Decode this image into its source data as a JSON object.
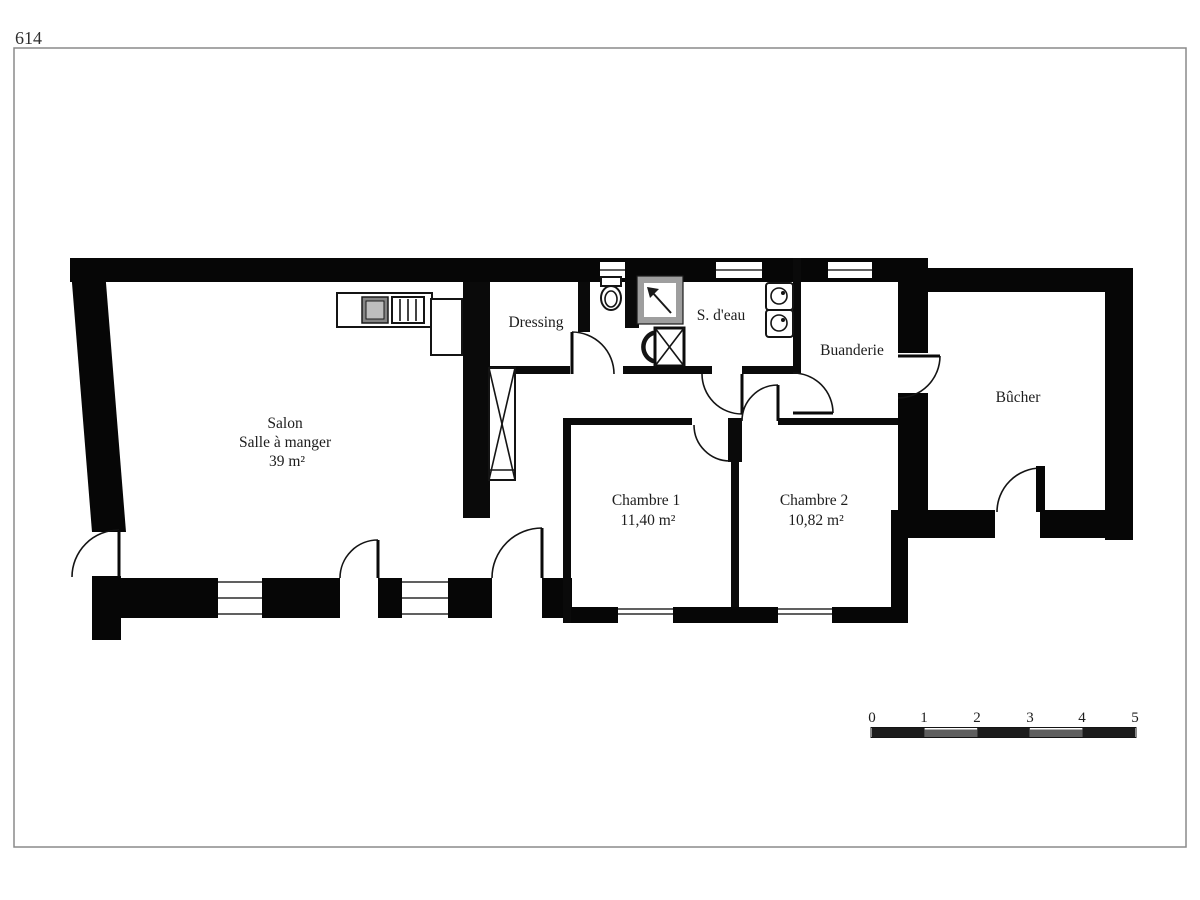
{
  "page": {
    "number": "614"
  },
  "rooms": {
    "salon": {
      "name": "Salon",
      "name2": "Salle à manger",
      "area": "39 m²"
    },
    "dressing": {
      "name": "Dressing"
    },
    "shower_room": {
      "name": "S. d'eau"
    },
    "laundry": {
      "name": "Buanderie"
    },
    "woodshed": {
      "name": "Bûcher"
    },
    "bedroom1": {
      "name": "Chambre 1",
      "area": "11,40 m²"
    },
    "bedroom2": {
      "name": "Chambre 2",
      "area": "10,82 m²"
    }
  },
  "scale_bar": {
    "ticks": [
      "0",
      "1",
      "2",
      "3",
      "4",
      "5"
    ]
  },
  "fixtures": [
    "kitchen-sink",
    "stove",
    "fridge-counter",
    "wardrobe-x",
    "toilet",
    "shower",
    "washbasin",
    "duct-x",
    "washer",
    "dryer"
  ],
  "colors": {
    "walls": "#060606",
    "background": "#ffffff",
    "page_border": "#8a8a8a",
    "shower_frame": "#9e9e9e",
    "scale_dark": "#1c1c1c",
    "scale_mid": "#5f5f5f"
  }
}
